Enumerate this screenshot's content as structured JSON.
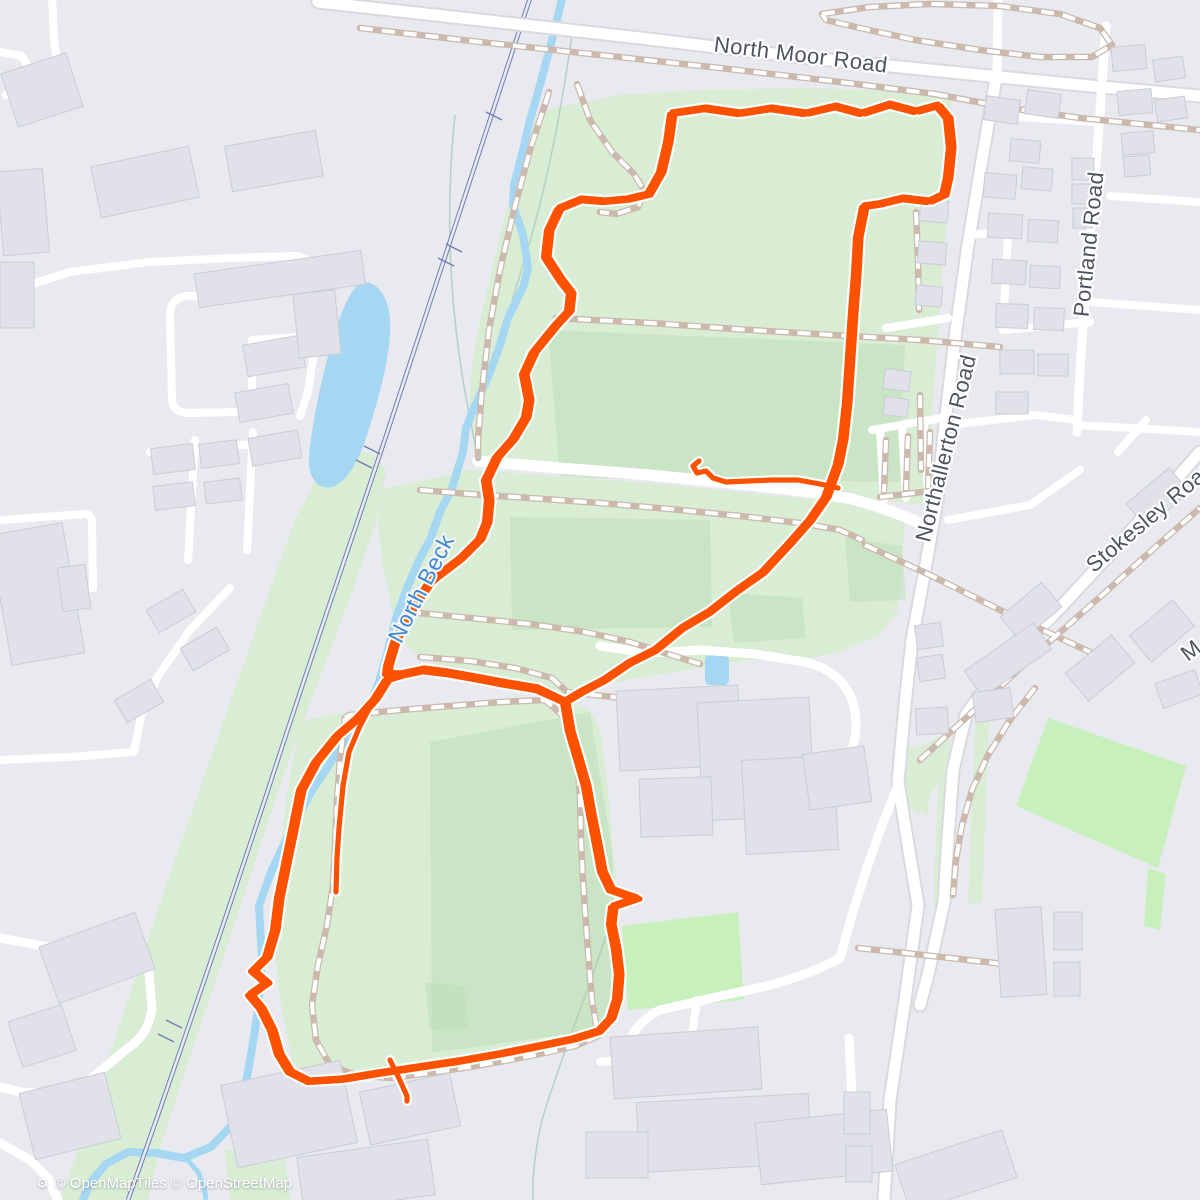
{
  "map": {
    "labels": {
      "north_moor_road": "North Moor Road",
      "northallerton_road": "Northallerton Road",
      "portland_road": "Portland Road",
      "stokesley_road": "Stokesley Road",
      "stokesley_fragment": "M",
      "north_beck": "North Beck"
    },
    "attribution": {
      "icon": "⚙",
      "text": "© OpenMapTiles © OpenStreetMap"
    },
    "colors": {
      "background": "#e9eaef",
      "park_green": "#d8edd3",
      "field_green_dark": "#bfdfba",
      "pitch_green": "#c8f0bd",
      "water_blue": "#a6d7f2",
      "railway_blue": "#6e7db6",
      "road_white": "#ffffff",
      "path_tan": "#cbb9ae",
      "building_gray": "#e0e1e9",
      "track_orange": "#fc5200",
      "track_casing": "#ffffff",
      "road_label_gray": "#4e545e",
      "water_label_blue": "#4789cd"
    },
    "track": {
      "color": "#fc5200",
      "upper_loop": [
        [
          672,
          112
        ],
        [
          706,
          107
        ],
        [
          740,
          112
        ],
        [
          772,
          107
        ],
        [
          806,
          112
        ],
        [
          836,
          105
        ],
        [
          862,
          112
        ],
        [
          890,
          103
        ],
        [
          916,
          110
        ],
        [
          938,
          104
        ],
        [
          948,
          116
        ],
        [
          951,
          145
        ],
        [
          948,
          175
        ],
        [
          944,
          193
        ],
        [
          929,
          200
        ],
        [
          903,
          197
        ],
        [
          878,
          203
        ],
        [
          864,
          205
        ],
        [
          858,
          235
        ],
        [
          856,
          272
        ],
        [
          853,
          310
        ],
        [
          850,
          355
        ],
        [
          847,
          400
        ],
        [
          843,
          437
        ],
        [
          838,
          462
        ],
        [
          826,
          495
        ],
        [
          810,
          518
        ],
        [
          788,
          543
        ],
        [
          762,
          571
        ],
        [
          735,
          590
        ],
        [
          708,
          611
        ],
        [
          681,
          627
        ],
        [
          654,
          649
        ],
        [
          628,
          662
        ],
        [
          603,
          679
        ],
        [
          580,
          691
        ],
        [
          565,
          700
        ],
        [
          538,
          687
        ],
        [
          508,
          682
        ],
        [
          476,
          676
        ],
        [
          448,
          671
        ],
        [
          424,
          668
        ],
        [
          400,
          673
        ],
        [
          387,
          672
        ],
        [
          388,
          664
        ],
        [
          395,
          640
        ],
        [
          410,
          610
        ],
        [
          430,
          580
        ],
        [
          460,
          557
        ],
        [
          480,
          537
        ],
        [
          487,
          520
        ],
        [
          489,
          498
        ],
        [
          486,
          478
        ],
        [
          497,
          455
        ],
        [
          513,
          437
        ],
        [
          526,
          415
        ],
        [
          529,
          398
        ],
        [
          524,
          372
        ],
        [
          534,
          350
        ],
        [
          556,
          323
        ],
        [
          569,
          309
        ],
        [
          571,
          291
        ],
        [
          561,
          278
        ],
        [
          546,
          255
        ],
        [
          549,
          228
        ],
        [
          559,
          207
        ],
        [
          581,
          198
        ],
        [
          605,
          200
        ],
        [
          627,
          198
        ],
        [
          648,
          193
        ],
        [
          661,
          170
        ],
        [
          668,
          140
        ]
      ],
      "lower_loop": [
        [
          375,
          697
        ],
        [
          357,
          717
        ],
        [
          337,
          734
        ],
        [
          316,
          760
        ],
        [
          301,
          788
        ],
        [
          293,
          828
        ],
        [
          286,
          862
        ],
        [
          279,
          896
        ],
        [
          275,
          928
        ],
        [
          267,
          955
        ],
        [
          253,
          969
        ],
        [
          267,
          981
        ],
        [
          250,
          993
        ],
        [
          261,
          1006
        ],
        [
          272,
          1028
        ],
        [
          279,
          1052
        ],
        [
          290,
          1070
        ],
        [
          310,
          1080
        ],
        [
          342,
          1078
        ],
        [
          378,
          1072
        ],
        [
          418,
          1066
        ],
        [
          458,
          1060
        ],
        [
          498,
          1053
        ],
        [
          538,
          1045
        ],
        [
          572,
          1038
        ],
        [
          598,
          1030
        ],
        [
          611,
          1016
        ],
        [
          617,
          997
        ],
        [
          619,
          972
        ],
        [
          616,
          947
        ],
        [
          611,
          922
        ],
        [
          613,
          905
        ],
        [
          637,
          897
        ],
        [
          611,
          888
        ],
        [
          602,
          869
        ],
        [
          597,
          842
        ],
        [
          591,
          812
        ],
        [
          586,
          784
        ],
        [
          578,
          756
        ],
        [
          570,
          729
        ],
        [
          565,
          700
        ],
        [
          538,
          688
        ],
        [
          508,
          683
        ],
        [
          476,
          677
        ],
        [
          448,
          672
        ],
        [
          424,
          669
        ],
        [
          400,
          674
        ],
        [
          387,
          678
        ]
      ],
      "start_stub": [
        [
          372,
          703
        ],
        [
          360,
          726
        ],
        [
          349,
          752
        ],
        [
          343,
          786
        ],
        [
          339,
          828
        ],
        [
          337,
          858
        ],
        [
          336,
          892
        ]
      ],
      "start_hook": [
        [
          838,
          488
        ],
        [
          820,
          484
        ],
        [
          798,
          480
        ],
        [
          772,
          480
        ],
        [
          748,
          481
        ],
        [
          726,
          482
        ],
        [
          713,
          478
        ],
        [
          706,
          471
        ],
        [
          697,
          473
        ],
        [
          693,
          466
        ],
        [
          699,
          461
        ]
      ],
      "finish_tail": [
        [
          390,
          1060
        ],
        [
          396,
          1072
        ],
        [
          402,
          1085
        ],
        [
          407,
          1096
        ],
        [
          407,
          1101
        ]
      ]
    }
  }
}
